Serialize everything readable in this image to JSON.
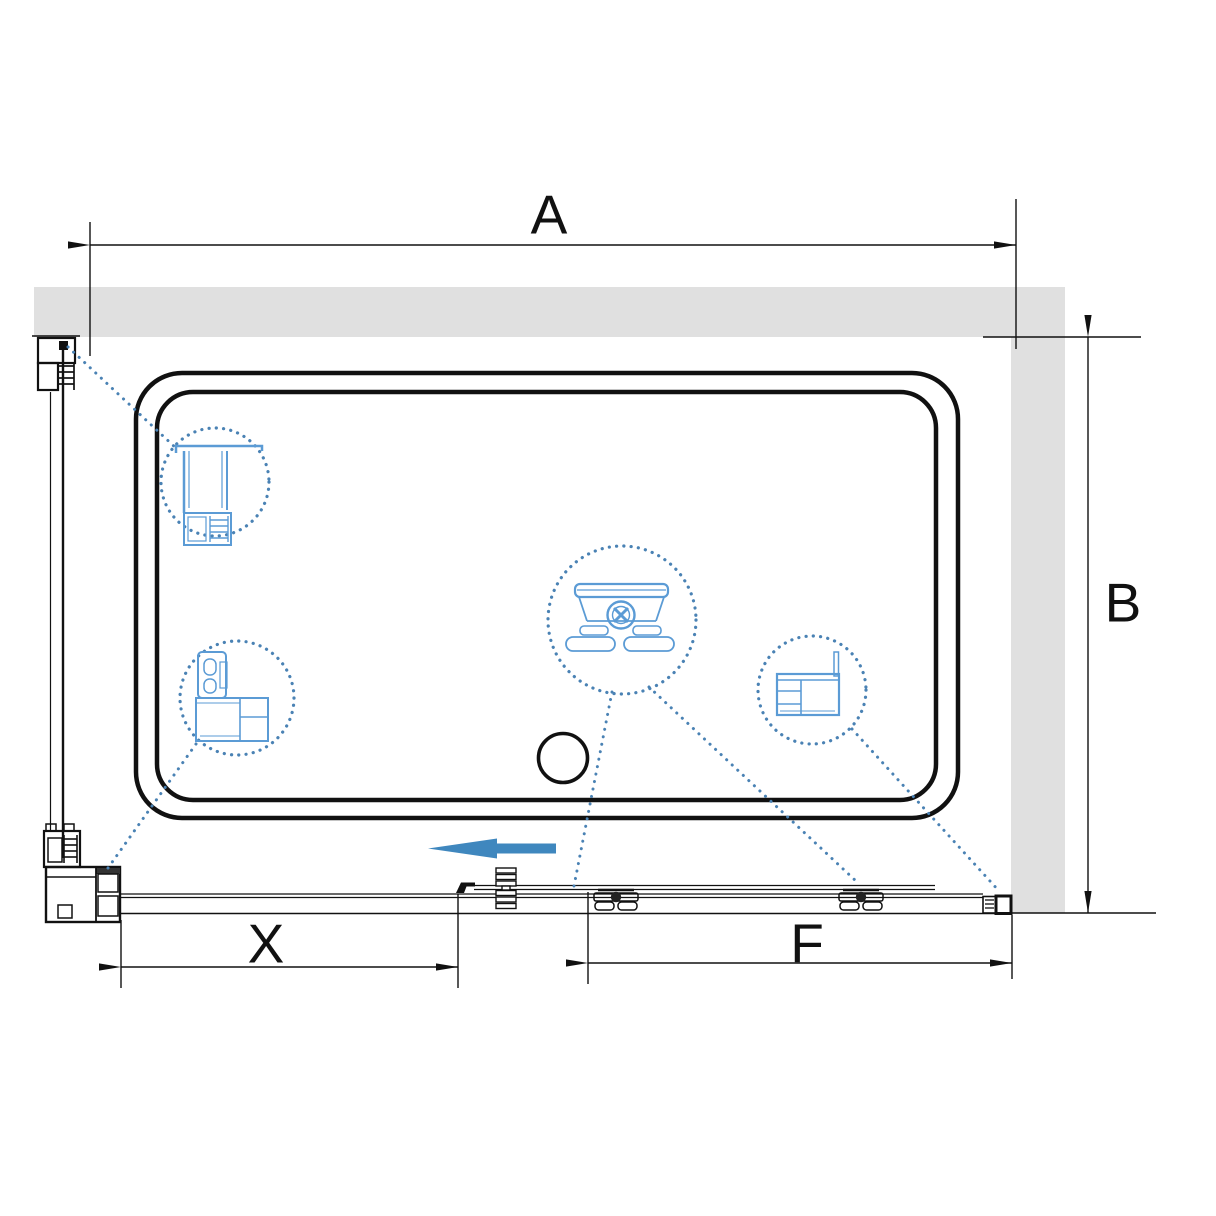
{
  "dimensions": {
    "a": {
      "label": "A"
    },
    "b": {
      "label": "B"
    },
    "x": {
      "label": "X"
    },
    "f": {
      "label": "F"
    }
  },
  "colors": {
    "background": "#ffffff",
    "wall_fill": "#e0e0e0",
    "line_black": "#111111",
    "arrow_blue": "#3f87be",
    "detail_blue": "#5b9bd5",
    "dotted_blue": "#4a82b4"
  },
  "icons": {
    "slide_direction": "slide-direction-arrow-icon",
    "drain": "drain-outlet-circle",
    "callout_top_left": "top-rail-profile-section",
    "callout_mid_left": "corner-post-profile-section",
    "callout_center": "roller-carriage-detail",
    "callout_right": "wall-profile-with-glass-section"
  }
}
